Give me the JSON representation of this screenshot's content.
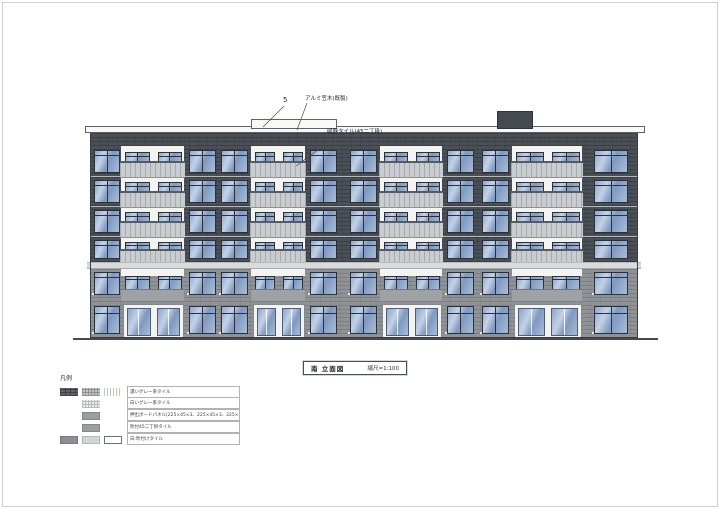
{
  "sheet": {
    "width": 720,
    "height": 509,
    "frame_color": "#cfd2d4"
  },
  "title_block": {
    "name": "南 立面図",
    "scale": "縮尺=1:100",
    "x": 303,
    "y": 361,
    "w": 104,
    "h": 14
  },
  "annotations": {
    "mark5": {
      "text": "5",
      "x": 283,
      "y": 96
    },
    "coping": {
      "text": "アルミ笠木(既製)",
      "x": 305,
      "y": 94
    },
    "tile": {
      "text": "磁器タイル(45二丁掛)",
      "x": 327,
      "y": 127
    },
    "leaders": [
      [
        284,
        106,
        263,
        127
      ],
      [
        307,
        103,
        297,
        130
      ],
      [
        338,
        135,
        296,
        166
      ]
    ]
  },
  "legend": {
    "header": "凡例",
    "x": 60,
    "y": 373,
    "items": [
      {
        "label": "濃いグレー系タイル",
        "swatches": [
          {
            "col": 0,
            "type": "brick-dark"
          },
          {
            "col": 1,
            "type": "hatch-mid"
          },
          {
            "col": 2,
            "type": "vlines-light"
          }
        ]
      },
      {
        "label": "白いグレー系タイル",
        "swatches": [
          {
            "col": 1,
            "type": "grid-light"
          }
        ]
      },
      {
        "label": "押出ボードパネル(225×45×3、225×45×3、225×7)",
        "swatches": [
          {
            "col": 1,
            "type": "solid-mid"
          }
        ]
      },
      {
        "label": "吹付45二丁掛タイル",
        "swatches": [
          {
            "col": 1,
            "type": "solid-mid"
          }
        ]
      },
      {
        "label": "白:吹付けタイル",
        "swatches": [
          {
            "col": 0,
            "type": "solid-gray"
          },
          {
            "col": 1,
            "type": "solid-lighter"
          },
          {
            "col": 2,
            "type": "outline"
          }
        ]
      }
    ]
  },
  "colors": {
    "wall_dark": "#4b5057",
    "wall_mid": "#909396",
    "white_bay": "#f3f3f0",
    "glass_a": "#8fa6c9",
    "glass_b": "#c3d2e6",
    "glass_c": "#7e99c0",
    "glass_d": "#a9bdd9",
    "frame": "#2b313a",
    "rail_bg": "#c9cdd0",
    "rail_line": "#a6abaf",
    "handrail": "#565b61",
    "band": "#dadbdc",
    "cap": "#f8f8f6",
    "cap_border": "#5f6368",
    "slab": "#b7babd",
    "outline": "#383d44",
    "ground": "#46494d",
    "upstand": "#9fa2a5",
    "sill": "#e9eae8",
    "roofbox": "#454a50",
    "frame_color": "#cfd2d4"
  },
  "building": {
    "x": 90,
    "w": 548,
    "top": 131,
    "bottom": 338,
    "upper_bottom": 262,
    "parapet_cap": {
      "x": 85,
      "y": 126,
      "w": 558,
      "h": 5
    },
    "raised_cap": {
      "x": 251,
      "y": 119,
      "w": 84,
      "h": 8
    },
    "roof_box": {
      "x": 497,
      "y": 111,
      "w": 34,
      "h": 16
    },
    "band": {
      "x": 87,
      "y": 262,
      "w": 554,
      "h": 5
    },
    "slab_ys": [
      176,
      206,
      236
    ],
    "ground": {
      "x": 73,
      "y": 338,
      "w": 585,
      "h": 2
    },
    "floors_upper": [
      {
        "y": 146,
        "h": 30
      },
      {
        "y": 176,
        "h": 30
      },
      {
        "y": 206,
        "h": 30
      },
      {
        "y": 236,
        "h": 26
      }
    ],
    "floor_2f": {
      "y": 266,
      "h": 34
    },
    "floor_1f": {
      "y": 300,
      "h": 38
    },
    "bays": [
      {
        "type": "dark",
        "x": 90,
        "w": 31,
        "win": "single"
      },
      {
        "type": "balcony",
        "x": 121,
        "w": 63
      },
      {
        "type": "dark",
        "x": 184,
        "w": 67,
        "win": "double"
      },
      {
        "type": "balcony",
        "x": 251,
        "w": 54
      },
      {
        "type": "dark",
        "x": 305,
        "w": 75,
        "win": "double"
      },
      {
        "type": "balcony",
        "x": 380,
        "w": 62
      },
      {
        "type": "dark",
        "x": 442,
        "w": 70,
        "win": "double"
      },
      {
        "type": "balcony",
        "x": 512,
        "w": 70
      },
      {
        "type": "dark",
        "x": 582,
        "w": 56,
        "win": "single-right"
      }
    ]
  }
}
